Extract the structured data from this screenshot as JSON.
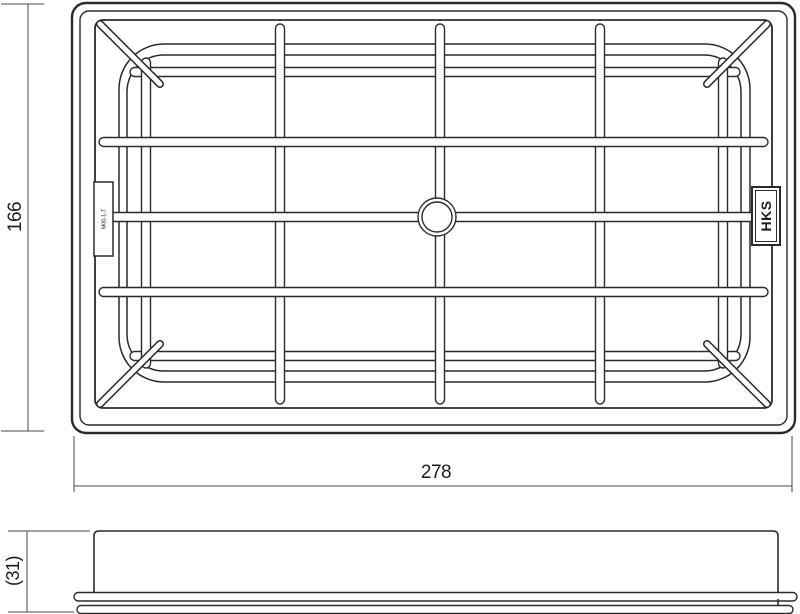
{
  "drawing": {
    "dimensions": {
      "height_label": "166",
      "width_label": "278",
      "side_height_label": "(31)"
    },
    "labels": {
      "brand_logo": "HKS",
      "part_code": "M00-1-T"
    },
    "colors": {
      "line": "#2b2b2b",
      "dimension_line": "#4a4a4a",
      "text": "#1e1e1e",
      "background": "#ffffff"
    }
  }
}
